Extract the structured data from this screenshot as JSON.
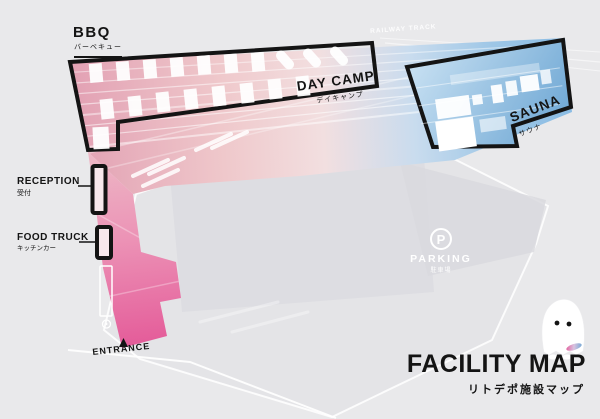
{
  "title": {
    "text": "FACILITY MAP",
    "subtext": "リトデポ施設マップ"
  },
  "areas": {
    "bbq": {
      "label": "BBQ",
      "sublabel": "バーベキュー"
    },
    "day_camp": {
      "label": "DAY CAMP",
      "sublabel": "デイキャンプ"
    },
    "sauna": {
      "label": "SAUNA",
      "sublabel": "サウナ"
    },
    "reception": {
      "label": "RECEPTION",
      "sublabel": "受付"
    },
    "food_truck": {
      "label": "FOOD TRUCK",
      "sublabel": "キッチンカー"
    },
    "parking": {
      "label": "PARKING",
      "sublabel": "駐車場",
      "icon_glyph": "P"
    },
    "entrance": {
      "label": "ENTRANCE"
    },
    "railway_track": {
      "label": "RAILWAY TRACK"
    }
  },
  "colors": {
    "deep_pink": "#e45b99",
    "light_pink": "#efc8cb",
    "steel_blue": "#6ea7d4",
    "light_blue": "#c4def1",
    "outline_black": "#141414",
    "site_gray": "#e4e4e7",
    "background_gray": "#e9e9eb",
    "white": "#ffffff"
  }
}
